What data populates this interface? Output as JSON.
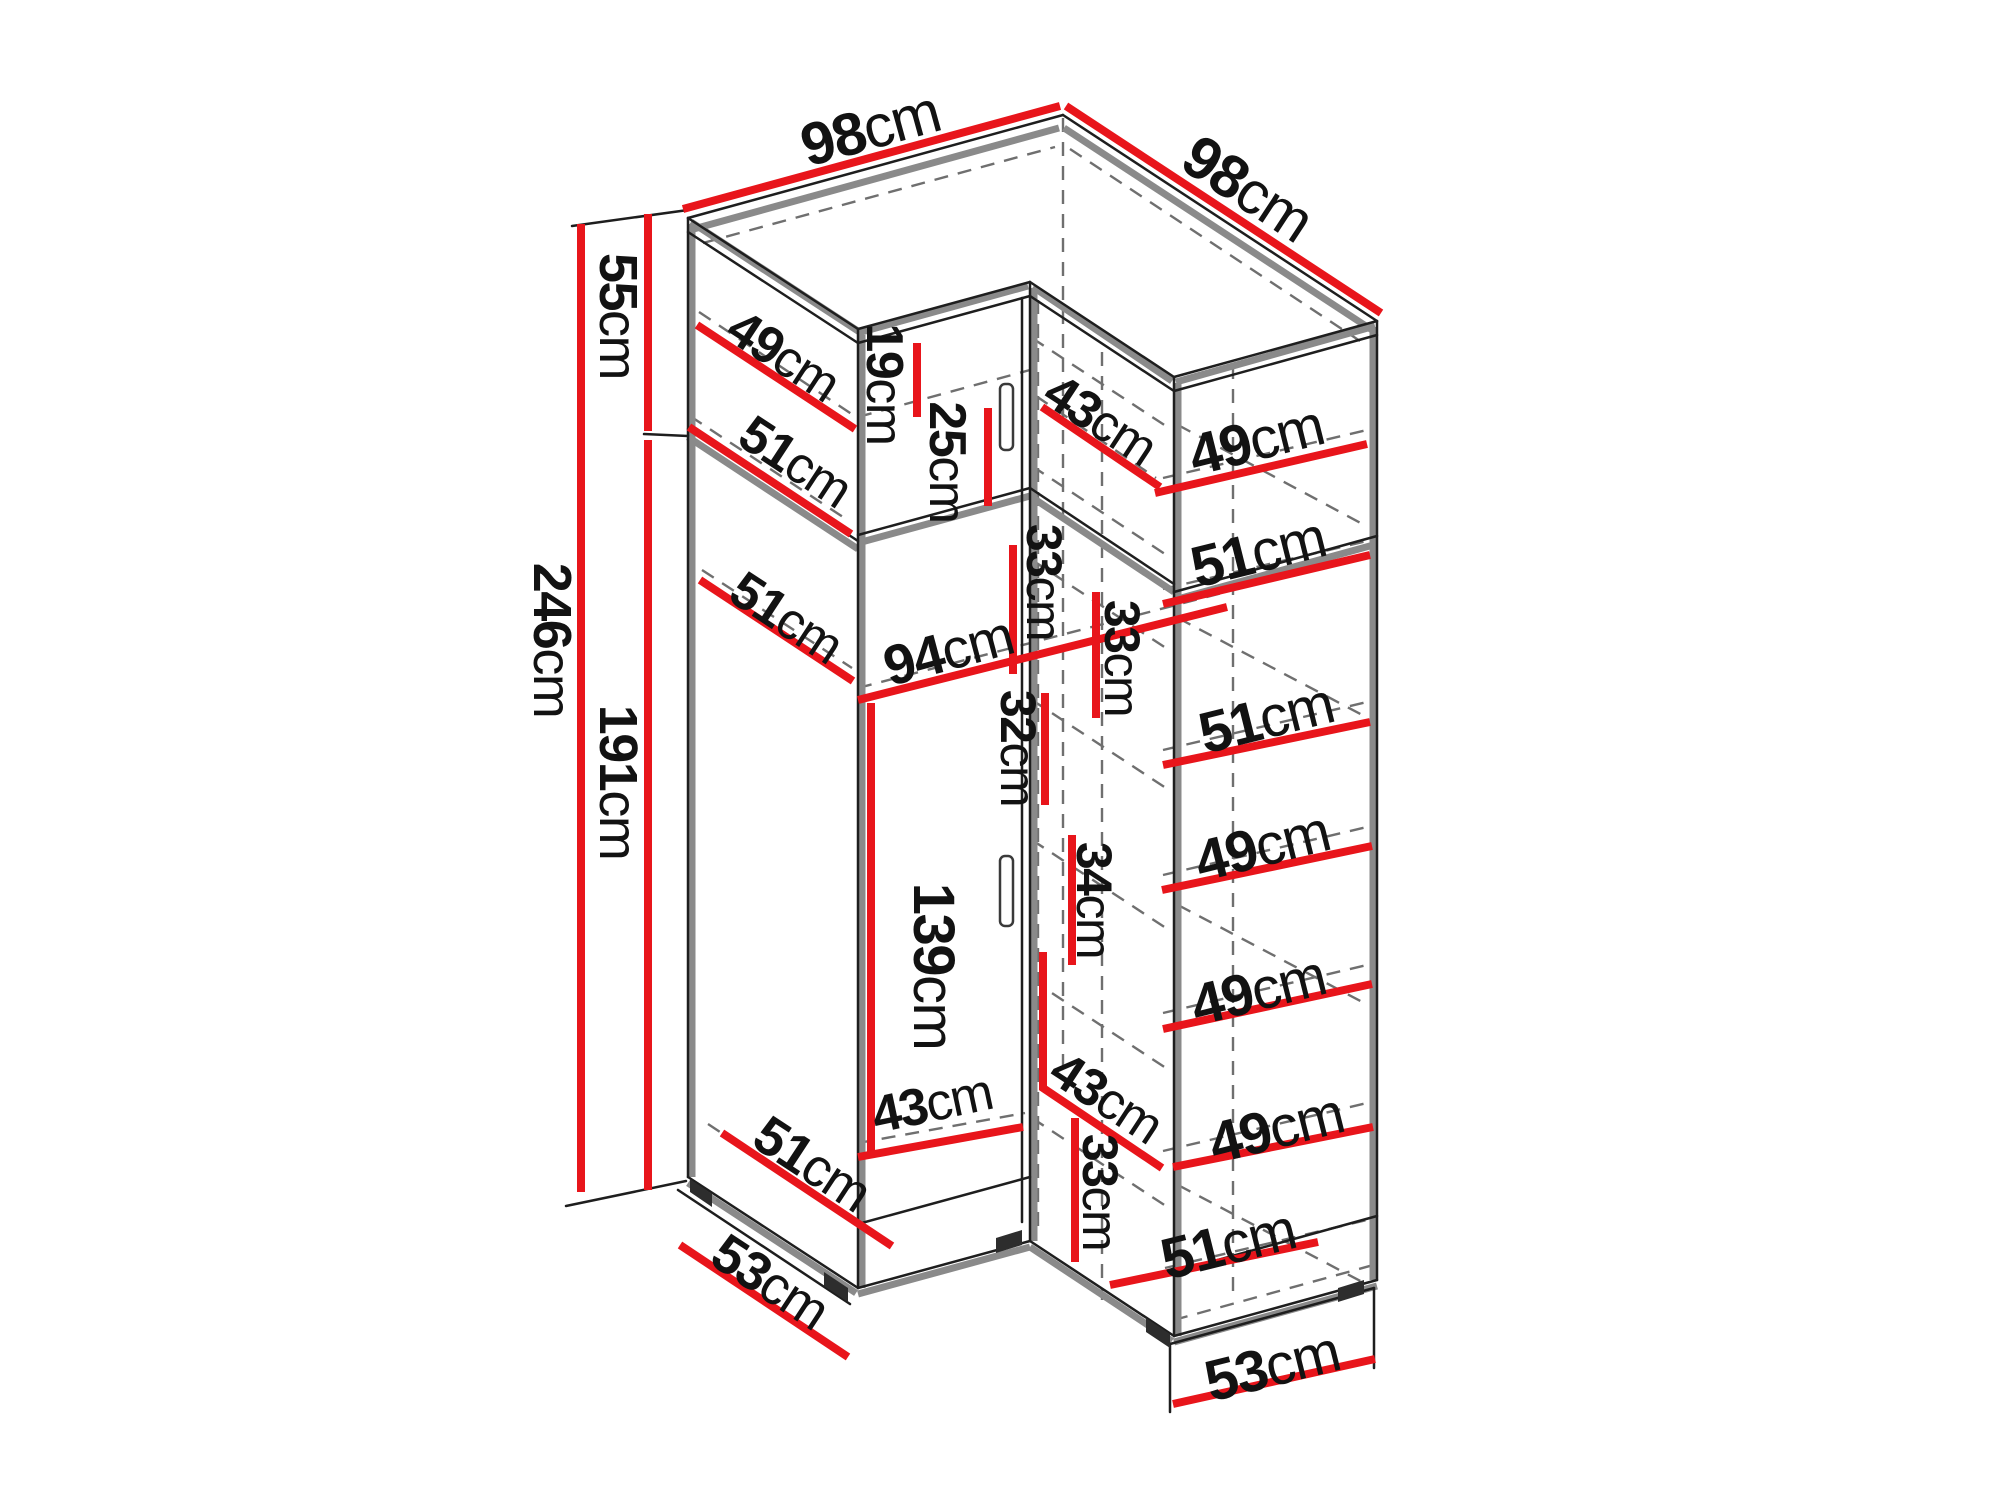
{
  "unit": "cm",
  "colors": {
    "dimension_red": "#e8151b",
    "outline_black": "#1e1e1e",
    "edge_grey": "#8a8a8a",
    "hidden_grey": "#6f6f6f",
    "background": "#ffffff"
  },
  "overall_dimensions": {
    "top_left_width": "98cm",
    "top_right_width": "98cm",
    "total_height": "246cm",
    "upper_section_height": "55cm",
    "lower_section_height": "191cm",
    "left_base_depth": "53cm",
    "right_base_depth": "53cm"
  },
  "dimensions": [
    {
      "id": "top-left-width",
      "v": "98",
      "u": "cm",
      "t": {
        "x": 870,
        "y": 128,
        "r": -15.4,
        "s": 60
      },
      "l": [
        683,
        209,
        1060,
        106
      ]
    },
    {
      "id": "top-right-width",
      "v": "98",
      "u": "cm",
      "t": {
        "x": 1248,
        "y": 188,
        "r": 33.3,
        "s": 60
      },
      "l": [
        1066,
        106,
        1381,
        313
      ]
    },
    {
      "id": "upper-height",
      "v": "55",
      "u": "cm",
      "t": {
        "x": 618,
        "y": 316,
        "r": 90,
        "s": 54
      },
      "l": [
        648,
        214,
        648,
        431
      ]
    },
    {
      "id": "total-height",
      "v": "246",
      "u": "cm",
      "t": {
        "x": 552,
        "y": 640,
        "r": 90,
        "s": 54
      },
      "l": [
        581,
        224,
        581,
        1192
      ]
    },
    {
      "id": "lower-height",
      "v": "191",
      "u": "cm",
      "t": {
        "x": 618,
        "y": 782,
        "r": 90,
        "s": 54
      },
      "l": [
        648,
        440,
        648,
        1190
      ]
    },
    {
      "id": "upper-shelf-depth-a",
      "v": "49",
      "u": "cm",
      "t": {
        "x": 783,
        "y": 356,
        "r": 33.3,
        "s": 52
      },
      "l": [
        697,
        325,
        855,
        429
      ]
    },
    {
      "id": "upper-shelf-depth-b",
      "v": "51",
      "u": "cm",
      "t": {
        "x": 795,
        "y": 462,
        "r": 33.3,
        "s": 52
      },
      "l": [
        689,
        427,
        851,
        534
      ]
    },
    {
      "id": "mid-shelf-depth",
      "v": "51",
      "u": "cm",
      "t": {
        "x": 786,
        "y": 618,
        "r": 33.3,
        "s": 52
      },
      "l": [
        700,
        580,
        853,
        681
      ]
    },
    {
      "id": "upper-gap",
      "v": "19",
      "u": "cm",
      "t": {
        "x": 884,
        "y": 384,
        "r": 90,
        "s": 52
      },
      "l": [
        917,
        343,
        917,
        417
      ]
    },
    {
      "id": "upper-gap-2",
      "v": "25",
      "u": "cm",
      "t": {
        "x": 947,
        "y": 462,
        "r": 90,
        "s": 52
      },
      "l": [
        988,
        408,
        988,
        506
      ]
    },
    {
      "id": "corner-gap-1",
      "v": "33",
      "u": "cm",
      "t": {
        "x": 1044,
        "y": 582,
        "r": 90,
        "s": 50
      },
      "l": [
        1013,
        545,
        1013,
        674
      ]
    },
    {
      "id": "interior-width",
      "v": "94",
      "u": "cm",
      "t": {
        "x": 948,
        "y": 650,
        "r": -15,
        "s": 56
      },
      "l": [
        858,
        700,
        1227,
        607
      ]
    },
    {
      "id": "corner-gap-2",
      "v": "33",
      "u": "cm",
      "t": {
        "x": 1122,
        "y": 658,
        "r": 90,
        "s": 50
      },
      "l": [
        1096,
        592,
        1096,
        718
      ]
    },
    {
      "id": "side-gap-32",
      "v": "32",
      "u": "cm",
      "t": {
        "x": 1018,
        "y": 748,
        "r": 90,
        "s": 50
      },
      "l": [
        1045,
        693,
        1045,
        805
      ]
    },
    {
      "id": "side-gap-34",
      "v": "34",
      "u": "cm",
      "t": {
        "x": 1094,
        "y": 900,
        "r": 90,
        "s": 50
      },
      "l": [
        1072,
        835,
        1072,
        965
      ]
    },
    {
      "id": "hanging-height",
      "v": "139",
      "u": "cm",
      "t": {
        "x": 934,
        "y": 966,
        "r": 90,
        "s": 58
      },
      "l": [
        871,
        703,
        871,
        1157
      ]
    },
    {
      "id": "top-corner-depth",
      "v": "43",
      "u": "cm",
      "t": {
        "x": 1100,
        "y": 420,
        "r": 33.3,
        "s": 52
      },
      "l": [
        1042,
        407,
        1160,
        487
      ]
    },
    {
      "id": "right-shelf-1",
      "v": "49",
      "u": "cm",
      "t": {
        "x": 1256,
        "y": 440,
        "r": -14,
        "s": 58
      },
      "l": [
        1155,
        493,
        1367,
        444
      ]
    },
    {
      "id": "right-shelf-2",
      "v": "51",
      "u": "cm",
      "t": {
        "x": 1258,
        "y": 552,
        "r": -14,
        "s": 58
      },
      "l": [
        1163,
        604,
        1370,
        555
      ]
    },
    {
      "id": "right-shelf-3",
      "v": "51",
      "u": "cm",
      "t": {
        "x": 1266,
        "y": 718,
        "r": -14,
        "s": 58
      },
      "l": [
        1163,
        765,
        1370,
        722
      ]
    },
    {
      "id": "right-shelf-4",
      "v": "49",
      "u": "cm",
      "t": {
        "x": 1262,
        "y": 846,
        "r": -14,
        "s": 58
      },
      "l": [
        1162,
        890,
        1372,
        846
      ]
    },
    {
      "id": "right-shelf-5",
      "v": "49",
      "u": "cm",
      "t": {
        "x": 1258,
        "y": 990,
        "r": -14,
        "s": 58
      },
      "l": [
        1163,
        1029,
        1372,
        984
      ]
    },
    {
      "id": "right-shelf-6",
      "v": "49",
      "u": "cm",
      "t": {
        "x": 1276,
        "y": 1128,
        "r": -14,
        "s": 58
      },
      "l": [
        1173,
        1167,
        1373,
        1127
      ]
    },
    {
      "id": "right-shelf-7",
      "v": "51",
      "u": "cm",
      "t": {
        "x": 1228,
        "y": 1244,
        "r": -14,
        "s": 58
      },
      "l": [
        1110,
        1285,
        1318,
        1242
      ]
    },
    {
      "id": "bottom-interior-width",
      "v": "43",
      "u": "cm",
      "t": {
        "x": 932,
        "y": 1104,
        "r": -12,
        "s": 52
      },
      "l": [
        858,
        1157,
        1023,
        1127
      ]
    },
    {
      "id": "bottom-corner-depth",
      "v": "43",
      "u": "cm",
      "t": {
        "x": 1106,
        "y": 1098,
        "r": 33.3,
        "s": 52
      },
      "p": "1043,952 1043,1088 1162,1168"
    },
    {
      "id": "bottom-corner-gap",
      "v": "33",
      "u": "cm",
      "t": {
        "x": 1100,
        "y": 1192,
        "r": 90,
        "s": 50
      },
      "l": [
        1075,
        1118,
        1075,
        1262
      ]
    },
    {
      "id": "bottom-left-shelf",
      "v": "51",
      "u": "cm",
      "t": {
        "x": 812,
        "y": 1164,
        "r": 33.3,
        "s": 54
      },
      "l": [
        722,
        1133,
        892,
        1246
      ]
    },
    {
      "id": "left-base-depth",
      "v": "53",
      "u": "cm",
      "t": {
        "x": 770,
        "y": 1282,
        "r": 33.3,
        "s": 54
      },
      "l": [
        680,
        1245,
        848,
        1357
      ]
    },
    {
      "id": "right-base-depth",
      "v": "53",
      "u": "cm",
      "t": {
        "x": 1272,
        "y": 1366,
        "r": -14,
        "s": 58
      },
      "l": [
        1173,
        1404,
        1375,
        1359
      ]
    }
  ]
}
